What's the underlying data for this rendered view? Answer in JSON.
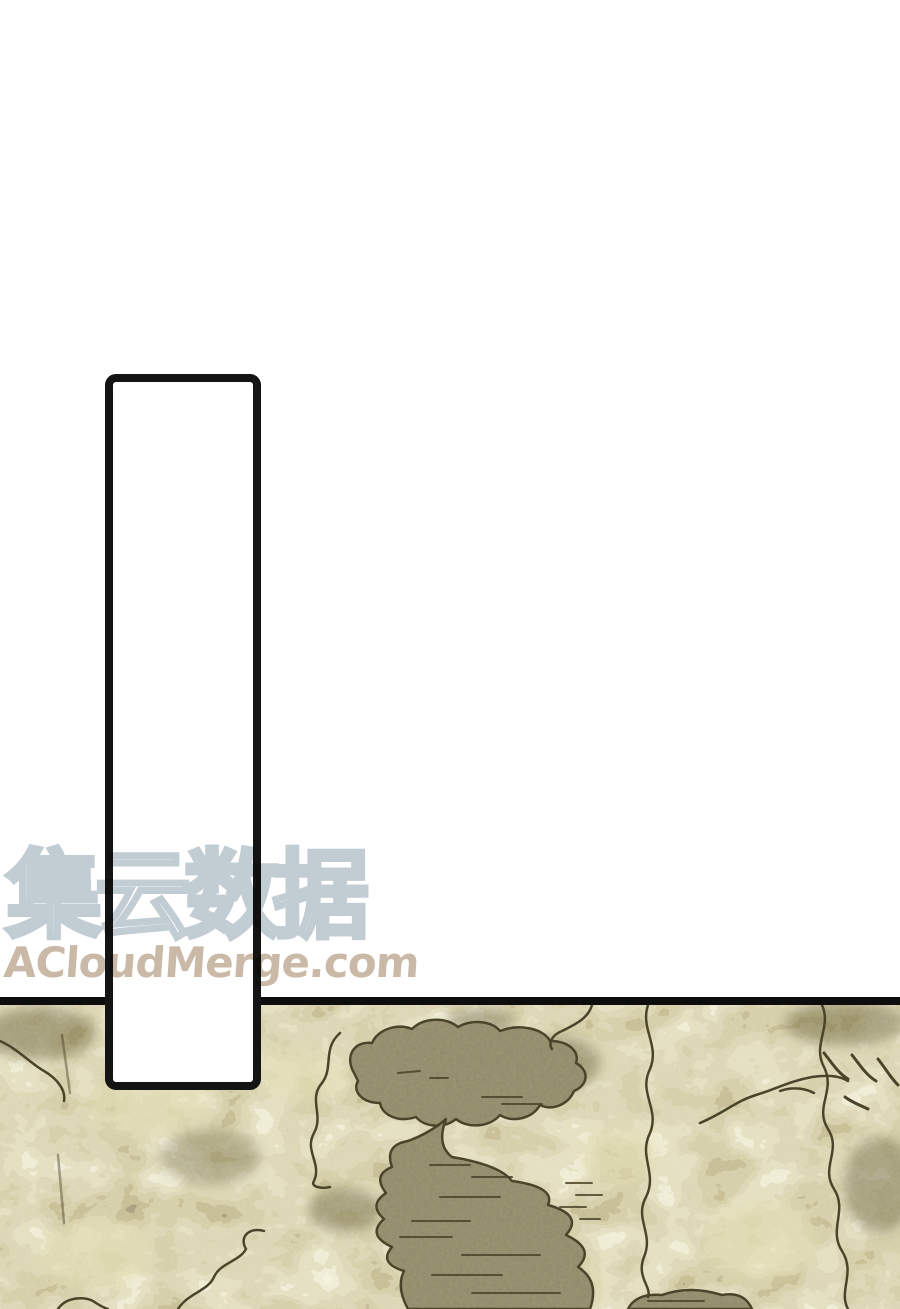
{
  "page": {
    "kind": "comic-page",
    "background_color": "#ffffff"
  },
  "watermark": {
    "cn_text": "集云数据",
    "cn_outline_color": "#c2ccd3",
    "site_text": "ACloudMerge.com",
    "site_color": "#c9b9a6"
  },
  "panel": {
    "fill_color": "#ffffff",
    "border_color": "#141414"
  },
  "terrain": {
    "divider_color": "#0d0d0d",
    "foliage_base_color": "#b8ab73",
    "foliage_light_color": "#e2dbae",
    "foliage_dark_color": "#69603a",
    "outline_color": "#453f27",
    "water_color": "#8d8667"
  }
}
